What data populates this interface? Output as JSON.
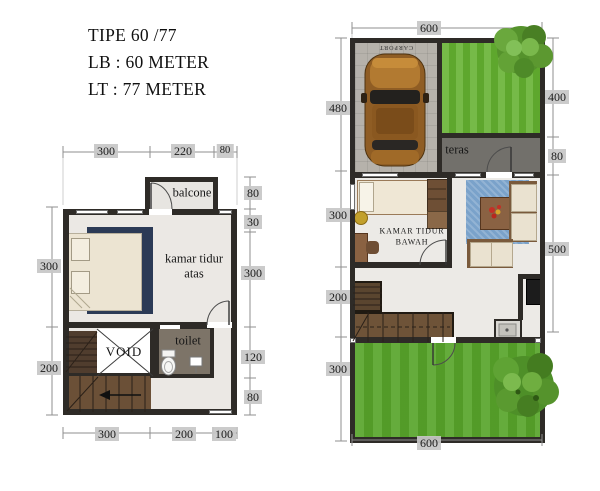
{
  "title": {
    "line1": "TIPE 60 /77",
    "line2": "LB : 60 METER",
    "line3": "LT : 77 METER"
  },
  "upper_floor": {
    "labels": {
      "balcony": "balcone",
      "bedroom_line1": "kamar tidur",
      "bedroom_line2": "atas",
      "void": "VOID",
      "toilet": "toilet"
    },
    "dims": {
      "top": [
        "300",
        "220",
        "80"
      ],
      "right": [
        "80",
        "30",
        "300",
        "120",
        "80"
      ],
      "left": [
        "300",
        "200"
      ],
      "bottom": [
        "300",
        "200",
        "100"
      ]
    }
  },
  "ground_floor": {
    "labels": {
      "carport": "CARPORT",
      "teras": "teras",
      "bedroom_line1": "KAMAR TIDUR",
      "bedroom_line2": "BAWAH"
    },
    "dims": {
      "top": [
        "600"
      ],
      "left": [
        "480",
        "300",
        "200",
        "300"
      ],
      "right": [
        "400",
        "80",
        "500"
      ],
      "bottom": [
        "600"
      ]
    }
  },
  "colors": {
    "wall": "#2e2b27",
    "floor": "#ebe8e4",
    "grass": "#5fae2e",
    "wood_stairs": "#6b5037",
    "bed_navy": "#2b3a56",
    "rug_blue": "#7aa2ca",
    "carport_concrete": "#b6b2ab",
    "teras_gray": "#72706b",
    "toilet_floor": "#7d7468",
    "dim_chip": "#c7c7c7",
    "car_bronze": "#9a6527"
  }
}
